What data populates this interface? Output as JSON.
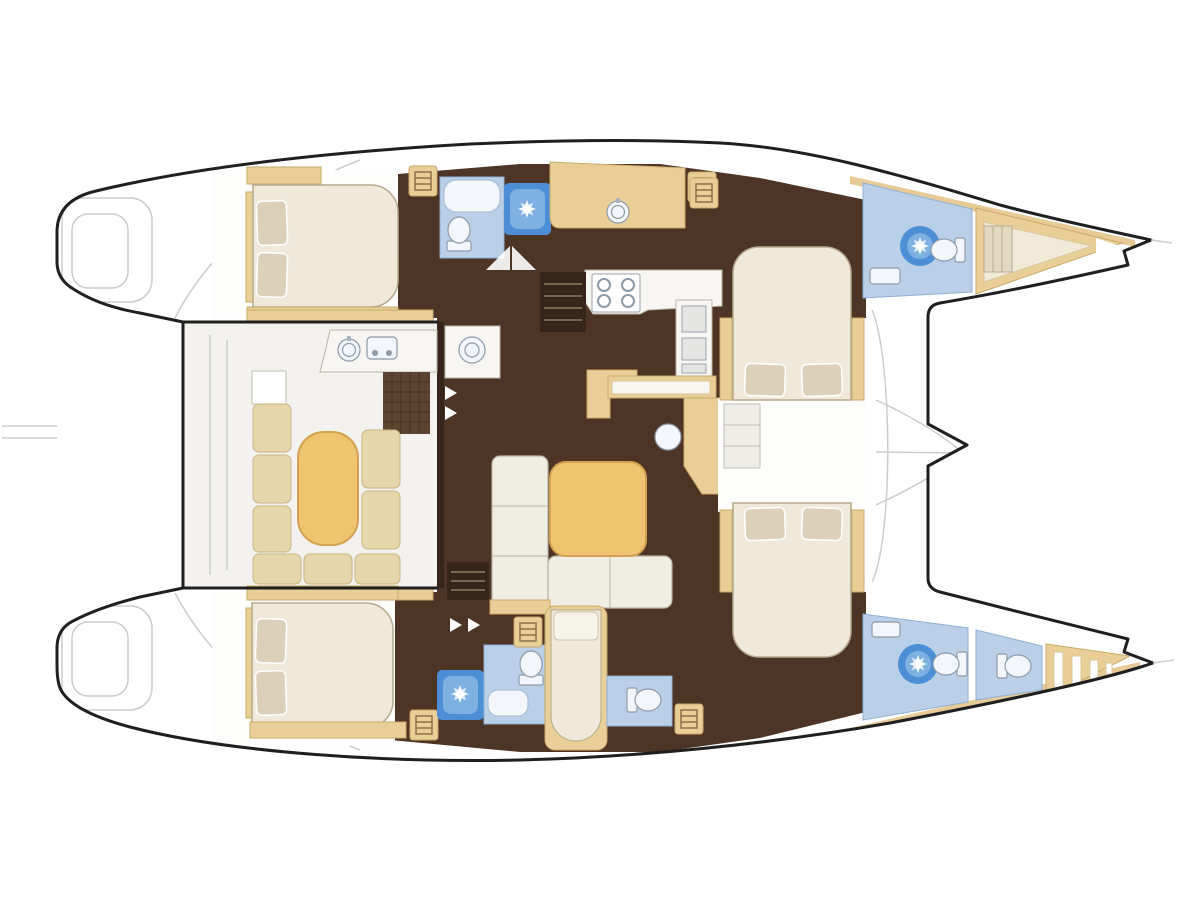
{
  "page": {
    "background": "#ffffff",
    "title": "Sailing catamaran interior layout plan, top view with bows to the right"
  },
  "palette": {
    "outline": "#1f1f1f",
    "ghost": "#cccccc",
    "floor": "#4d3425",
    "floor_dark": "#38251a",
    "tan": "#e9cf97",
    "tan_edge": "#c9a96b",
    "tan_deep": "#e2bd7d",
    "table": "#eec470",
    "table_edge": "#d3a251",
    "cream": "#f0e9d9",
    "cream_edge": "#b6a98c",
    "pillow": "#dcd0b8",
    "sofa": "#f0ede3",
    "sofa_edge": "#b8b2a2",
    "cockpit": "#f3f2ee",
    "bath": "#b9d0e8",
    "bath_edge": "#8fb0d4",
    "bath_fix": "#f3f6fa",
    "shower": "#4c8fd6",
    "shower_core": "#7fb0e2",
    "fixture_edge": "#8d9aa8",
    "counter": "#f7f6f2",
    "counter_edge": "#b9b4a6"
  },
  "plan": {
    "vessel": "twin-hull catamaran, sterns with swim steps at left, pointed bows at right, trampoline between bows",
    "zones": [
      {
        "id": "aft-cockpit",
        "label": "Aft cockpit with U-shaped seating, oval table, side table and wet bar with sink and grill"
      },
      {
        "id": "salon",
        "label": "Salon with L-shaped sofa, square coffee table, aft sink counter, galley island bar and chart desk with stool"
      },
      {
        "id": "galley",
        "label": "Galley in top hull with long counter, round sink, 4-burner stove and appliance column"
      },
      {
        "id": "top-aft-cabin",
        "label": "Top hull aft double cabin, pillows aft"
      },
      {
        "id": "top-aft-head",
        "label": "Top hull aft bathroom with toilet and separate shower stall"
      },
      {
        "id": "top-forward-cabin",
        "label": "Top hull forward double cabin, pillows inboard"
      },
      {
        "id": "top-forward-head",
        "label": "Top hull forward bathroom with round shower, toilet and sink"
      },
      {
        "id": "top-bow-berth",
        "label": "Top bow V-berth crew area"
      },
      {
        "id": "bottom-aft-cabin",
        "label": "Bottom hull aft double cabin, pillows aft"
      },
      {
        "id": "bottom-aft-head",
        "label": "Bottom hull aft bathroom with shower stall, toilet and basin"
      },
      {
        "id": "bottom-single-berth",
        "label": "Bottom hull narrow single berth"
      },
      {
        "id": "bottom-mid-head",
        "label": "Bottom hull middle toilet room"
      },
      {
        "id": "bottom-forward-cabin",
        "label": "Bottom hull forward double cabin, pillows inboard"
      },
      {
        "id": "bottom-forward-head",
        "label": "Bottom hull forward bathroom with round shower, toilet and sink"
      },
      {
        "id": "bottom-bow-head",
        "label": "Bottom bow extra toilet compartment"
      },
      {
        "id": "bottom-forepeak",
        "label": "Bottom bow forepeak locker with slats"
      },
      {
        "id": "trampoline",
        "label": "Foredeck trampoline between bows with seams converging to forebeam point"
      }
    ],
    "fixtures_count": {
      "double_beds": 4,
      "single_berths": 1,
      "bow_v_berths": 1,
      "toilets": 5,
      "shower_indicators": 4,
      "sinks": 5,
      "stove_burners": 4,
      "grills": 1,
      "companionway_step_cabinets": 5
    }
  }
}
